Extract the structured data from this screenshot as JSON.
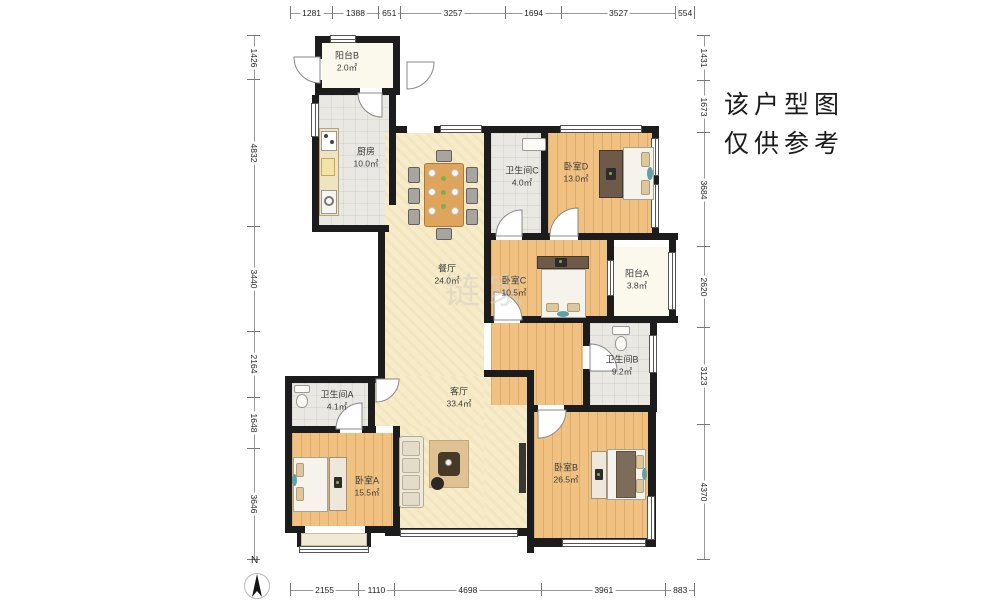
{
  "note": {
    "line1": "该户型图",
    "line2": "仅供参考"
  },
  "compass_label": "N",
  "watermark": "链家",
  "rooms": [
    {
      "name": "阳台B",
      "area": "2.0㎡"
    },
    {
      "name": "厨房",
      "area": "10.0㎡"
    },
    {
      "name": "餐厅",
      "area": "24.0㎡"
    },
    {
      "name": "卫生间C",
      "area": "4.0㎡"
    },
    {
      "name": "卧室D",
      "area": "13.0㎡"
    },
    {
      "name": "卧室C",
      "area": "10.5㎡"
    },
    {
      "name": "阳台A",
      "area": "3.8㎡"
    },
    {
      "name": "卫生间B",
      "area": "9.2㎡"
    },
    {
      "name": "客厅",
      "area": "33.4㎡"
    },
    {
      "name": "卫生间A",
      "area": "4.1㎡"
    },
    {
      "name": "卧室A",
      "area": "15.5㎡"
    },
    {
      "name": "卧室B",
      "area": "26.5㎡"
    }
  ],
  "dimensions": {
    "top": [
      "1281",
      "1388",
      "651",
      "3257",
      "1694",
      "3527",
      "554"
    ],
    "bottom": [
      "2155",
      "1110",
      "4698",
      "3961",
      "883"
    ],
    "left": [
      "1426",
      "4832",
      "3440",
      "2164",
      "1648",
      "3646"
    ],
    "right": [
      "1431",
      "1673",
      "3684",
      "2620",
      "3123",
      "4370"
    ]
  },
  "colors": {
    "wall": "#1c1c1c",
    "wood_floor": "#f0c180",
    "open_area_floor": "#f7ecca",
    "tile_floor": "#e9e8e3",
    "balcony_floor": "#fbf8ec",
    "accent_teal": "#62a0a8",
    "table_wood": "#e0a55c"
  }
}
